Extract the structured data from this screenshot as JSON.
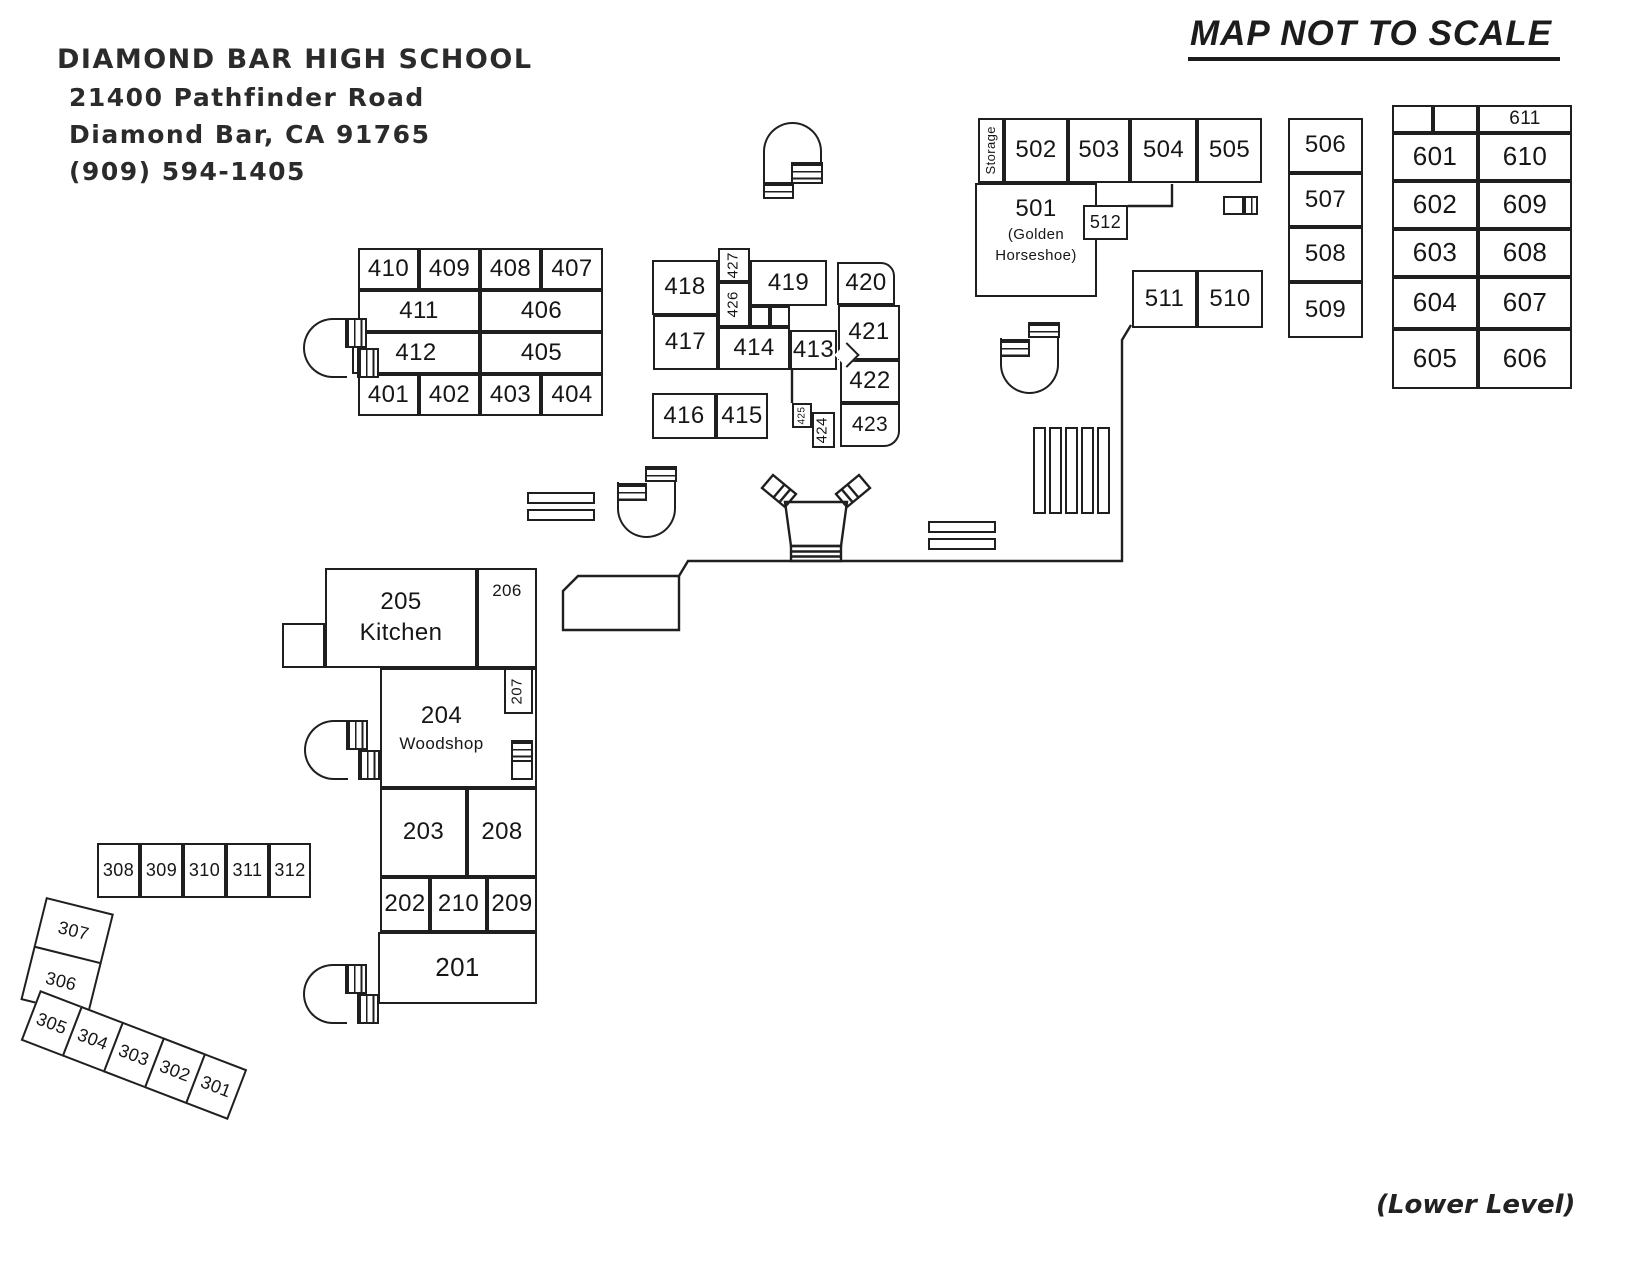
{
  "header": {
    "school_name": "DIAMOND BAR HIGH SCHOOL",
    "address_line1": "21400 Pathfinder Road",
    "address_line2": "Diamond Bar, CA 91765",
    "phone": "(909) 594-1405"
  },
  "annotations": {
    "scale_note": "MAP NOT TO SCALE",
    "level_note": "(Lower Level)"
  },
  "colors": {
    "ink": "#1f1f1f",
    "paper": "#ffffff"
  },
  "rooms": [
    {
      "l": "410",
      "x": 358,
      "y": 248,
      "w": 61,
      "h": 42
    },
    {
      "l": "409",
      "x": 419,
      "y": 248,
      "w": 61,
      "h": 42
    },
    {
      "l": "408",
      "x": 480,
      "y": 248,
      "w": 61,
      "h": 42
    },
    {
      "l": "407",
      "x": 541,
      "y": 248,
      "w": 62,
      "h": 42
    },
    {
      "l": "411",
      "x": 358,
      "y": 290,
      "w": 122,
      "h": 42
    },
    {
      "l": "406",
      "x": 480,
      "y": 290,
      "w": 123,
      "h": 42
    },
    {
      "l": "412",
      "x": 352,
      "y": 332,
      "w": 128,
      "h": 42
    },
    {
      "l": "405",
      "x": 480,
      "y": 332,
      "w": 123,
      "h": 42
    },
    {
      "l": "401",
      "x": 358,
      "y": 374,
      "w": 61,
      "h": 42
    },
    {
      "l": "402",
      "x": 419,
      "y": 374,
      "w": 61,
      "h": 42
    },
    {
      "l": "403",
      "x": 480,
      "y": 374,
      "w": 61,
      "h": 42
    },
    {
      "l": "404",
      "x": 541,
      "y": 374,
      "w": 62,
      "h": 42
    },
    {
      "l": "418",
      "x": 652,
      "y": 260,
      "w": 66,
      "h": 55
    },
    {
      "l": "427",
      "x": 718,
      "y": 248,
      "w": 32,
      "h": 34,
      "rot": true,
      "fs": 15
    },
    {
      "l": "419",
      "x": 750,
      "y": 260,
      "w": 77,
      "h": 46
    },
    {
      "l": "426",
      "x": 718,
      "y": 282,
      "w": 32,
      "h": 45,
      "rot": true,
      "fs": 15
    },
    {
      "l": "",
      "x": 750,
      "y": 306,
      "w": 20,
      "h": 21
    },
    {
      "l": "",
      "x": 770,
      "y": 306,
      "w": 20,
      "h": 21
    },
    {
      "l": "417",
      "x": 653,
      "y": 315,
      "w": 65,
      "h": 55
    },
    {
      "l": "414",
      "x": 718,
      "y": 327,
      "w": 72,
      "h": 43
    },
    {
      "l": "413",
      "x": 790,
      "y": 330,
      "w": 47,
      "h": 40
    },
    {
      "l": "416",
      "x": 652,
      "y": 393,
      "w": 64,
      "h": 46
    },
    {
      "l": "415",
      "x": 716,
      "y": 393,
      "w": 52,
      "h": 46
    },
    {
      "l": "425",
      "x": 792,
      "y": 403,
      "w": 20,
      "h": 25,
      "rot": true,
      "fs": 10
    },
    {
      "l": "424",
      "x": 812,
      "y": 412,
      "w": 23,
      "h": 36,
      "rot": true,
      "fs": 15
    },
    {
      "l": "420",
      "x": 837,
      "y": 262,
      "w": 58,
      "h": 43,
      "r": "0 14px 0 0"
    },
    {
      "l": "421",
      "x": 838,
      "y": 305,
      "w": 62,
      "h": 55
    },
    {
      "l": "422",
      "x": 840,
      "y": 360,
      "w": 60,
      "h": 43
    },
    {
      "l": "423",
      "x": 840,
      "y": 403,
      "w": 60,
      "h": 44,
      "fs": 21,
      "r": "0 0 16px 0"
    },
    {
      "l": "Storage",
      "x": 978,
      "y": 118,
      "w": 26,
      "h": 65,
      "rot": true,
      "fs": 13
    },
    {
      "l": "502",
      "x": 1004,
      "y": 118,
      "w": 64,
      "h": 65
    },
    {
      "l": "503",
      "x": 1068,
      "y": 118,
      "w": 62,
      "h": 65
    },
    {
      "l": "504",
      "x": 1130,
      "y": 118,
      "w": 67,
      "h": 65
    },
    {
      "l": "505",
      "x": 1197,
      "y": 118,
      "w": 65,
      "h": 65
    },
    {
      "l": "501",
      "x": 975,
      "y": 183,
      "w": 122,
      "h": 114,
      "valign": "top",
      "sub": [
        "(Golden",
        "Horseshoe)"
      ],
      "subFs": 15
    },
    {
      "l": "512",
      "x": 1083,
      "y": 205,
      "w": 45,
      "h": 35,
      "fs": 18
    },
    {
      "l": "511",
      "x": 1132,
      "y": 270,
      "w": 65,
      "h": 58
    },
    {
      "l": "510",
      "x": 1197,
      "y": 270,
      "w": 66,
      "h": 58
    },
    {
      "l": "506",
      "x": 1288,
      "y": 118,
      "w": 75,
      "h": 55
    },
    {
      "l": "507",
      "x": 1288,
      "y": 173,
      "w": 75,
      "h": 54
    },
    {
      "l": "508",
      "x": 1288,
      "y": 227,
      "w": 75,
      "h": 55
    },
    {
      "l": "509",
      "x": 1288,
      "y": 282,
      "w": 75,
      "h": 56
    },
    {
      "l": "",
      "x": 1392,
      "y": 105,
      "w": 41,
      "h": 28
    },
    {
      "l": "",
      "x": 1433,
      "y": 105,
      "w": 45,
      "h": 28
    },
    {
      "l": "611",
      "x": 1478,
      "y": 105,
      "w": 94,
      "h": 28,
      "fs": 19
    },
    {
      "l": "601",
      "x": 1392,
      "y": 133,
      "w": 86,
      "h": 48,
      "fs": 26
    },
    {
      "l": "610",
      "x": 1478,
      "y": 133,
      "w": 94,
      "h": 48,
      "fs": 26
    },
    {
      "l": "602",
      "x": 1392,
      "y": 181,
      "w": 86,
      "h": 48,
      "fs": 26
    },
    {
      "l": "609",
      "x": 1478,
      "y": 181,
      "w": 94,
      "h": 48,
      "fs": 26
    },
    {
      "l": "603",
      "x": 1392,
      "y": 229,
      "w": 86,
      "h": 48,
      "fs": 26
    },
    {
      "l": "608",
      "x": 1478,
      "y": 229,
      "w": 94,
      "h": 48,
      "fs": 26
    },
    {
      "l": "604",
      "x": 1392,
      "y": 277,
      "w": 86,
      "h": 52,
      "fs": 26
    },
    {
      "l": "607",
      "x": 1478,
      "y": 277,
      "w": 94,
      "h": 52,
      "fs": 26
    },
    {
      "l": "605",
      "x": 1392,
      "y": 329,
      "w": 86,
      "h": 60,
      "fs": 26
    },
    {
      "l": "606",
      "x": 1478,
      "y": 329,
      "w": 94,
      "h": 60,
      "fs": 26
    },
    {
      "l": "",
      "x": 282,
      "y": 623,
      "w": 43,
      "h": 45
    },
    {
      "l": "205",
      "x": 325,
      "y": 568,
      "w": 152,
      "h": 100,
      "sub": [
        "Kitchen"
      ],
      "subFs": 24
    },
    {
      "l": "206",
      "x": 477,
      "y": 568,
      "w": 60,
      "h": 100,
      "fs": 17,
      "valign": "top"
    },
    {
      "l": "204",
      "x": 380,
      "y": 668,
      "w": 157,
      "h": 120,
      "sub": [
        "Woodshop"
      ],
      "subFs": 17,
      "padR": 34
    },
    {
      "l": "207",
      "x": 504,
      "y": 668,
      "w": 29,
      "h": 46,
      "rot": true,
      "fs": 15
    },
    {
      "l": "203",
      "x": 380,
      "y": 788,
      "w": 87,
      "h": 89
    },
    {
      "l": "208",
      "x": 467,
      "y": 788,
      "w": 70,
      "h": 89
    },
    {
      "l": "202",
      "x": 380,
      "y": 877,
      "w": 50,
      "h": 55
    },
    {
      "l": "210",
      "x": 430,
      "y": 877,
      "w": 57,
      "h": 55
    },
    {
      "l": "209",
      "x": 487,
      "y": 877,
      "w": 50,
      "h": 55
    },
    {
      "l": "201",
      "x": 378,
      "y": 932,
      "w": 159,
      "h": 72,
      "fs": 26
    },
    {
      "l": "308",
      "x": 97,
      "y": 843,
      "w": 43,
      "h": 55,
      "fs": 18
    },
    {
      "l": "309",
      "x": 140,
      "y": 843,
      "w": 43,
      "h": 55,
      "fs": 18
    },
    {
      "l": "310",
      "x": 183,
      "y": 843,
      "w": 43,
      "h": 55,
      "fs": 18
    },
    {
      "l": "311",
      "x": 226,
      "y": 843,
      "w": 43,
      "h": 55,
      "fs": 18
    },
    {
      "l": "312",
      "x": 269,
      "y": 843,
      "w": 42,
      "h": 55,
      "fs": 18
    }
  ],
  "tilted_groups": [
    {
      "name": "block-306-307",
      "x": 46,
      "y": 897,
      "rot": 14,
      "cells": [
        {
          "l": "307",
          "x": 0,
          "y": 0,
          "w": 70,
          "h": 52,
          "fs": 18
        },
        {
          "l": "306",
          "x": 0,
          "y": 50,
          "w": 70,
          "h": 56,
          "fs": 18
        }
      ]
    },
    {
      "name": "row-301-305",
      "x": 40,
      "y": 990,
      "rot": 21,
      "cells": [
        {
          "l": "305",
          "x": 0,
          "y": 0,
          "w": 46,
          "h": 54,
          "fs": 18
        },
        {
          "l": "304",
          "x": 44,
          "y": 0,
          "w": 46,
          "h": 54,
          "fs": 18
        },
        {
          "l": "303",
          "x": 88,
          "y": 0,
          "w": 46,
          "h": 54,
          "fs": 18
        },
        {
          "l": "302",
          "x": 132,
          "y": 0,
          "w": 46,
          "h": 54,
          "fs": 18
        },
        {
          "l": "301",
          "x": 176,
          "y": 0,
          "w": 46,
          "h": 54,
          "fs": 18
        }
      ]
    }
  ],
  "icons": [
    {
      "type": "stairwell-left",
      "x": 303,
      "y": 318
    },
    {
      "type": "stairwell-left",
      "x": 304,
      "y": 720
    },
    {
      "type": "stairwell-left",
      "x": 303,
      "y": 964
    },
    {
      "type": "stairwell-top",
      "x": 763,
      "y": 122
    },
    {
      "type": "stairwell-curve",
      "x": 617,
      "y": 466
    },
    {
      "type": "stairwell-curve",
      "x": 1000,
      "y": 322
    },
    {
      "type": "stairs-small",
      "x": 511,
      "y": 740
    },
    {
      "type": "table",
      "x": 1223,
      "y": 196
    },
    {
      "type": "bench-h",
      "x": 527,
      "y": 492
    },
    {
      "type": "bench-h",
      "x": 527,
      "y": 509
    },
    {
      "type": "bench-h",
      "x": 928,
      "y": 521
    },
    {
      "type": "bench-h",
      "x": 928,
      "y": 538
    },
    {
      "type": "bench-v",
      "x": 1033,
      "y": 427
    },
    {
      "type": "bench-v",
      "x": 1049,
      "y": 427
    },
    {
      "type": "bench-v",
      "x": 1065,
      "y": 427
    },
    {
      "type": "bench-v",
      "x": 1081,
      "y": 427
    },
    {
      "type": "bench-v",
      "x": 1097,
      "y": 427
    },
    {
      "type": "arrow-right",
      "x": 838,
      "y": 346
    }
  ]
}
